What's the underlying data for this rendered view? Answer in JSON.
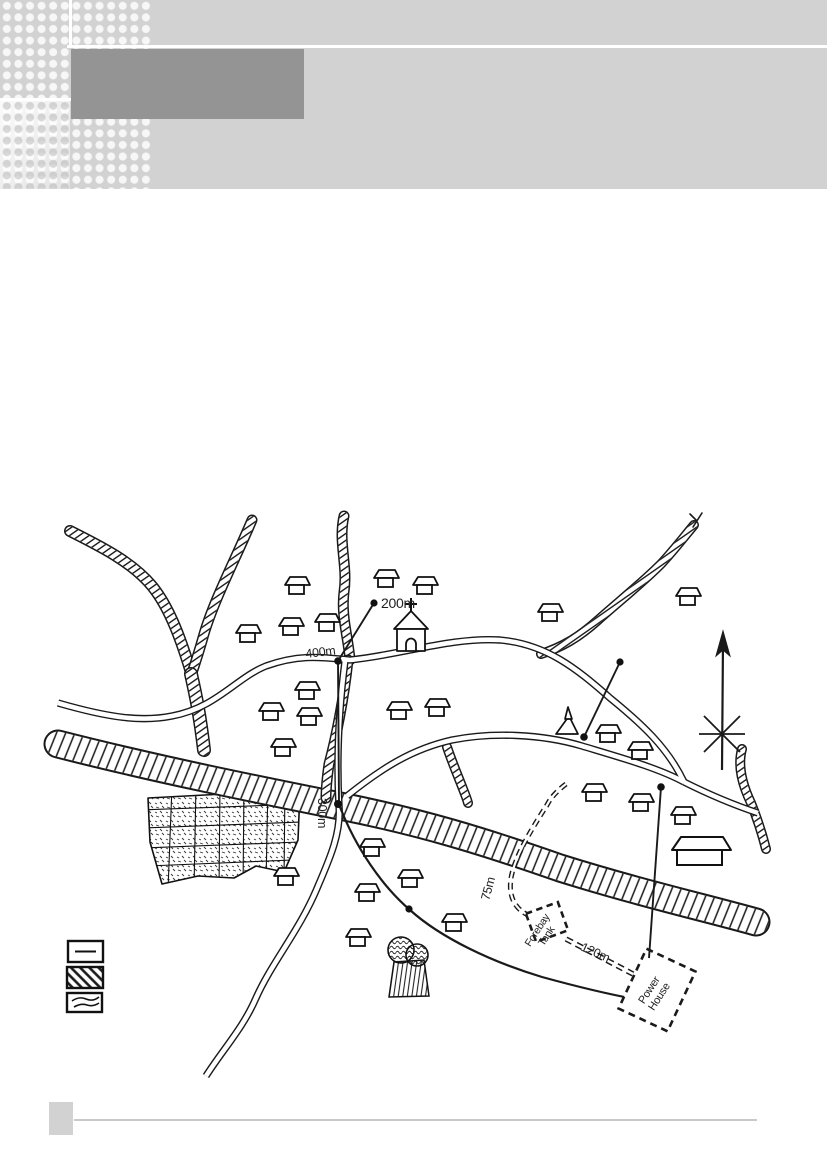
{
  "header": {
    "band_color": "#d2d2d2",
    "title_box_color": "#949494"
  },
  "map": {
    "labels": {
      "l200": "200m",
      "l400": "400m",
      "l300": "300m",
      "l75": "75m",
      "l120": "120m",
      "forebay1": "Forebay",
      "forebay2": "Tank",
      "power1": "Power",
      "power2": "House"
    },
    "legend": {
      "items": [
        {
          "symbol": "road"
        },
        {
          "symbol": "river"
        },
        {
          "symbol": "stream"
        }
      ]
    },
    "compass": {
      "direction": "north"
    },
    "ink_color": "#1a1a1a"
  }
}
